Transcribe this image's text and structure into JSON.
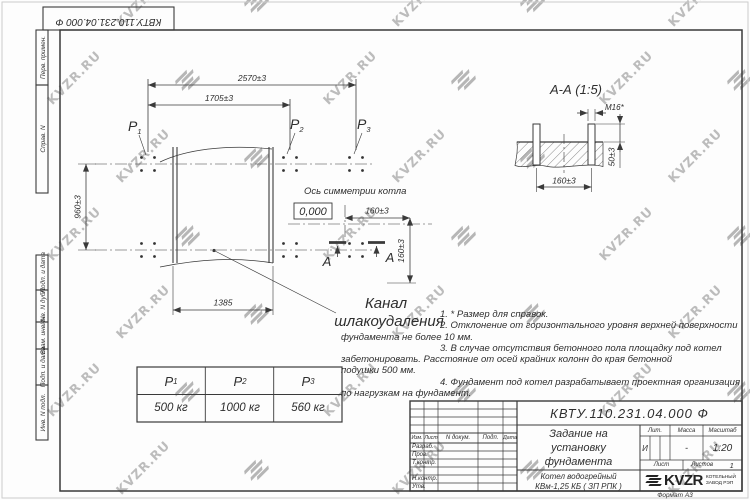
{
  "watermark": {
    "text": "KVZR.RU"
  },
  "top_margin": {
    "doc_number": "КВТУ.110.231.04.000 Ф"
  },
  "side_columns": {
    "labels": [
      "Перв. примен.",
      "Справ. N",
      "Подп. и дата",
      "Инв. N дубл.",
      "Взам. инв. N",
      "Подп. и дата",
      "Инв. N подл."
    ]
  },
  "plan": {
    "dim_overall": "2570±3",
    "dim_left": "1705±3",
    "dim_height": "960±3",
    "dim_channel": "1385",
    "dim_offset_h": "160±3",
    "dim_offset_v": "160±3",
    "points": [
      {
        "base": "P",
        "sub": "1"
      },
      {
        "base": "P",
        "sub": "2"
      },
      {
        "base": "P",
        "sub": "3"
      }
    ],
    "axis_label": "Ось симметрии котла",
    "elevation": "0,000",
    "section_letter": "А",
    "channel_label_line1": "Канал",
    "channel_label_line2": "шлакоудаления"
  },
  "section_view": {
    "title": "А-А  (1:5)",
    "bolt_label": "М16*",
    "dim_spacing": "160±3",
    "dim_protrusion": "50±3"
  },
  "notes": {
    "lines": [
      "1. * Размер для справок.",
      "2. Отклонение от горизонтального уровня верхней поверхности",
      "фундамента не более 10 мм.",
      "3. В случае отсутствия бетонного пола площадку под котел",
      "забетонировать. Расстояние от осей крайних колонн до края бетонной",
      "подушки 500 мм.",
      "4. Фундамент под котел разрабатывает проектная организация",
      "по нагрузкам на фундамент."
    ]
  },
  "loads_table": {
    "headers": [
      {
        "base": "P",
        "sub": "1"
      },
      {
        "base": "P",
        "sub": "2"
      },
      {
        "base": "P",
        "sub": "3"
      }
    ],
    "values": [
      "500 кг",
      "1000 кг",
      "560 кг"
    ]
  },
  "title_block": {
    "doc_number": "КВТУ.110.231.04.000  Ф",
    "title_line1": "Задание на",
    "title_line2": "установку",
    "title_line3": "фундамента",
    "product_line1": "Котел водогрейный",
    "product_line2": "КВм-1,25 КБ ( ЗП РПК )",
    "header_izm": "Изм.",
    "header_list": "Лист",
    "header_doc": "N докум.",
    "header_podp": "Подп.",
    "header_data": "Дата",
    "sign_rows": [
      "Разраб.",
      "Пров.",
      "Т.контр.",
      "",
      "Н.контр.",
      "Утв."
    ],
    "lit_label": "Лит.",
    "mass_label": "Масса",
    "scale_label": "Масштаб",
    "lit_value": "И",
    "mass_value": "-",
    "scale_value": "1:20",
    "sheet_label": "Лист",
    "sheets_label": "Листов",
    "sheets_value": "1",
    "brand": "KVZR",
    "company_line1": "КОТЕЛЬНЫЙ",
    "company_line2": "ЗАВОД РЭП",
    "format": "Формат А3"
  }
}
